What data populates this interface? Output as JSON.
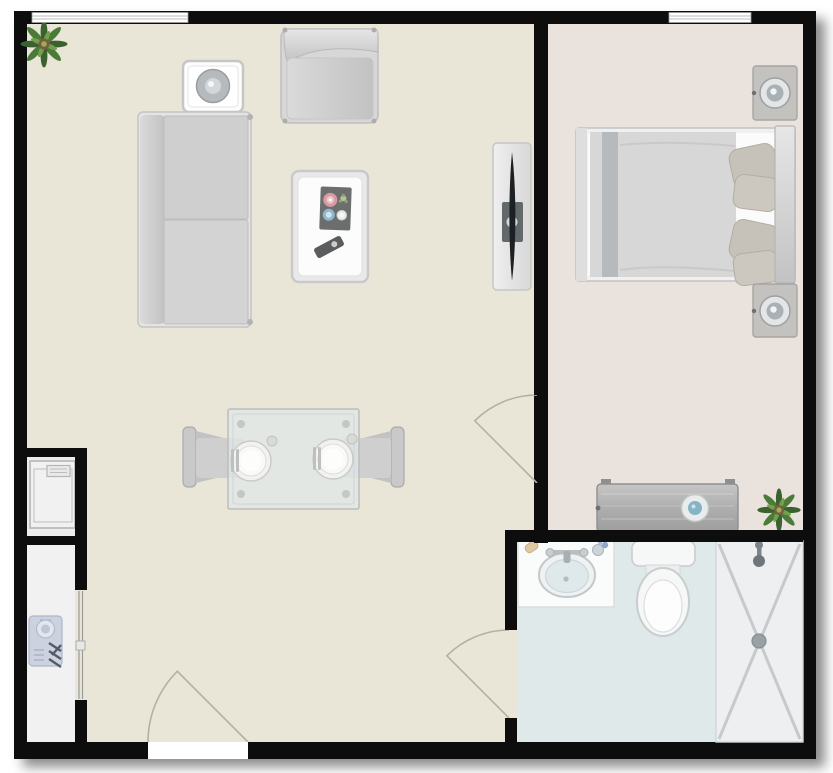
{
  "app": {
    "type": "floor-plan",
    "view": "2d-top-down",
    "title": "One-bedroom apartment floor plan"
  },
  "canvas": {
    "width": 833,
    "height": 773
  },
  "colors": {
    "wall": "#0d0d0d",
    "living_floor": "#eae6d7",
    "bedroom_floor": "#e9e2dd",
    "bathroom_floor": "#dfe9ea",
    "shower_floor": "#edeff0",
    "laundry_floor": "#ededed",
    "wardrobe_floor": "#f1f1f1",
    "furniture_gray": "#d6d6d6",
    "plant_green": "#4c7a38",
    "knob_blue": "#85b4c4",
    "pillow_tan": "#c7c2b9"
  },
  "rooms": [
    {
      "id": "living-room",
      "label": "Living room",
      "items": [
        {
          "label": "Potted plant"
        },
        {
          "label": "Side table with lamp"
        },
        {
          "label": "Armchair"
        },
        {
          "label": "Sofa"
        },
        {
          "label": "Coffee table with serving tray and remote"
        },
        {
          "label": "TV on media stand"
        },
        {
          "label": "Glass dining table with two place settings"
        },
        {
          "label": "Dining chair (left)"
        },
        {
          "label": "Dining chair (right)"
        }
      ]
    },
    {
      "id": "bedroom",
      "label": "Bedroom",
      "items": [
        {
          "label": "Nightstand with lamp (top)"
        },
        {
          "label": "Double bed with pillows"
        },
        {
          "label": "Nightstand with lamp (bottom)"
        },
        {
          "label": "Dresser with knob"
        },
        {
          "label": "Potted plant"
        }
      ]
    },
    {
      "id": "bathroom",
      "label": "Bathroom",
      "items": [
        {
          "label": "Vanity with oval sink"
        },
        {
          "label": "Toilet"
        },
        {
          "label": "Walk-in shower with drain"
        }
      ]
    },
    {
      "id": "laundry-closet",
      "label": "Laundry closet",
      "items": [
        {
          "label": "Washing machine"
        }
      ]
    },
    {
      "id": "wardrobe-closet",
      "label": "Wardrobe closet",
      "items": [
        {
          "label": "Folded clothing"
        }
      ]
    }
  ],
  "openings": {
    "windows": [
      {
        "label": "Window (top wall, living room)"
      },
      {
        "label": "Window (top wall, bedroom)"
      }
    ],
    "doors": [
      {
        "label": "Entry door (bottom wall)"
      },
      {
        "label": "Bedroom door"
      },
      {
        "label": "Bathroom door"
      },
      {
        "label": "Wardrobe sliding door"
      }
    ]
  }
}
